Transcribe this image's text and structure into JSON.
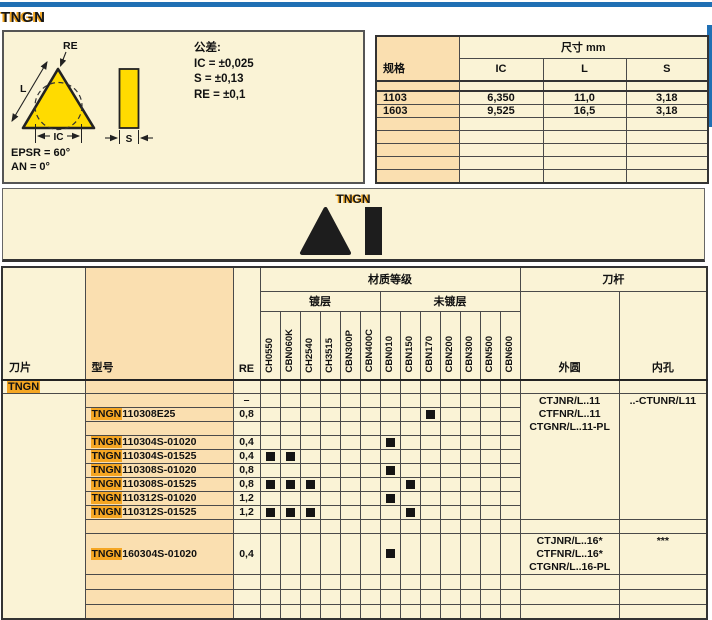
{
  "page": {
    "title": "TNGN",
    "colors": {
      "accent_blue": "#2070B4",
      "cream": "#FAF3D6",
      "cell_orange": "#FADFB0",
      "highlight_orange": "#F5A623",
      "insert_yellow": "#FFDB00"
    }
  },
  "drawing": {
    "labels": {
      "re": "RE",
      "l": "L",
      "ic": "IC",
      "s": "S"
    },
    "epsr": "EPSR = 60°",
    "an": "AN = 0°",
    "tolerance": {
      "title": "公差:",
      "lines": [
        "IC = ±0,025",
        "S = ±0,13",
        "RE = ±0,1"
      ]
    }
  },
  "dim_table": {
    "col_spec": "规格",
    "col_dim": "尺寸 mm",
    "cols": [
      "IC",
      "L",
      "S"
    ],
    "rows": [
      {
        "spec": "1103",
        "ic": "6,350",
        "l": "11,0",
        "s": "3,18"
      },
      {
        "spec": "1603",
        "ic": "9,525",
        "l": "16,5",
        "s": "3,18"
      }
    ],
    "leading_empty_rows": 1,
    "trailing_empty_rows": 5
  },
  "band": {
    "label": "TNGN"
  },
  "matrix": {
    "col_insert": "刀片",
    "col_model": "型号",
    "col_re": "RE",
    "grade_group": "材质等级",
    "coated": "镀层",
    "uncoated": "未镀层",
    "toolholder": "刀杆",
    "col_external": "外圆",
    "col_internal": "内孔",
    "grades": [
      "CH0550",
      "CBN060K",
      "CH2540",
      "CH3515",
      "CBN300P",
      "CBN400C",
      "CBN010",
      "CBN150",
      "CBN170",
      "CBN200",
      "CBN300",
      "CBN500",
      "CBN600"
    ],
    "section_label": "TNGN",
    "rows": [
      {
        "kind": "section"
      },
      {
        "kind": "data",
        "model": "",
        "re": "–",
        "marks": [],
        "holder": 0,
        "holderSpan": 9
      },
      {
        "kind": "data",
        "model": "TNGN110308E25",
        "re": "0,8",
        "marks": [
          8
        ]
      },
      {
        "kind": "empty"
      },
      {
        "kind": "data",
        "model": "TNGN110304S-01020",
        "re": "0,4",
        "marks": [
          6
        ]
      },
      {
        "kind": "data",
        "model": "TNGN110304S-01525",
        "re": "0,4",
        "marks": [
          0,
          1
        ]
      },
      {
        "kind": "data",
        "model": "TNGN110308S-01020",
        "re": "0,8",
        "marks": [
          6
        ]
      },
      {
        "kind": "data",
        "model": "TNGN110308S-01525",
        "re": "0,8",
        "marks": [
          0,
          1,
          2,
          7
        ]
      },
      {
        "kind": "data",
        "model": "TNGN110312S-01020",
        "re": "1,2",
        "marks": [
          6
        ]
      },
      {
        "kind": "data",
        "model": "TNGN110312S-01525",
        "re": "1,2",
        "marks": [
          0,
          1,
          2,
          7
        ]
      },
      {
        "kind": "empty"
      },
      {
        "kind": "data",
        "model": "TNGN160304S-01020",
        "re": "0,4",
        "marks": [
          6
        ],
        "tall": true,
        "holder": 1,
        "holderSpan": 1
      },
      {
        "kind": "end"
      },
      {
        "kind": "end"
      },
      {
        "kind": "end"
      }
    ],
    "holders": [
      {
        "external": [
          "CTJNR/L..11",
          "CTFNR/L..11",
          "CTGNR/L..11-PL"
        ],
        "internal": "..-CTUNR/L11"
      },
      {
        "external": [
          "CTJNR/L..16*",
          "CTFNR/L..16*",
          "CTGNR/L..16-PL"
        ],
        "internal": "***"
      }
    ]
  }
}
